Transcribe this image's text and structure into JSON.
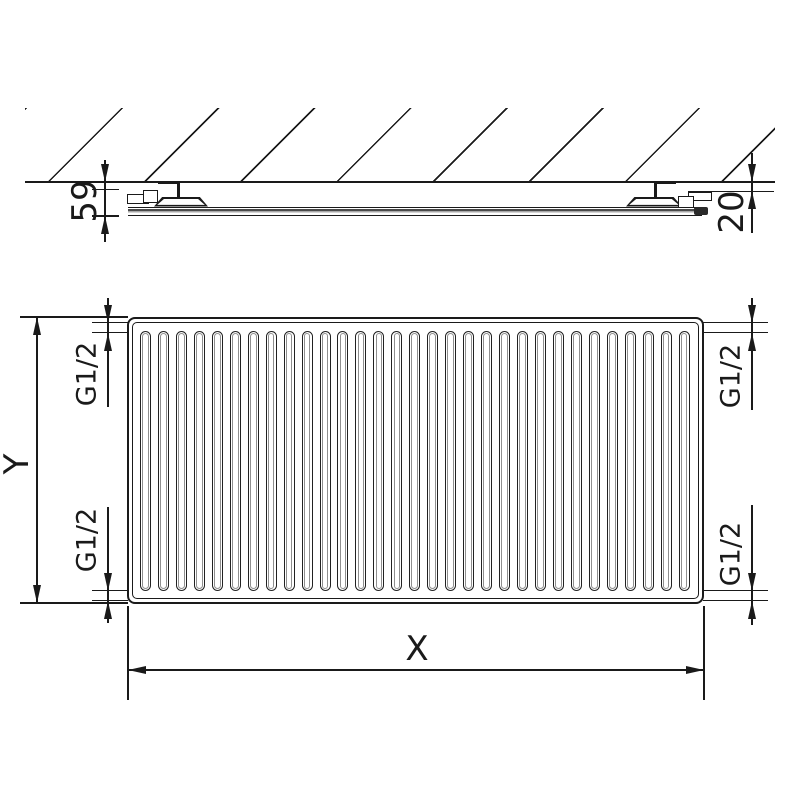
{
  "side_view": {
    "depth_label": "59",
    "wall_offset_label": "20"
  },
  "front_view": {
    "width_label": "X",
    "height_label": "Y",
    "fin_count": 31,
    "connections": {
      "top_left": "G1/2",
      "top_right": "G1/2",
      "bottom_left": "G1/2",
      "bottom_right": "G1/2"
    }
  },
  "colors": {
    "line": "#1a1a1a",
    "fin_inner": "#8f8f8f",
    "background": "#ffffff"
  }
}
